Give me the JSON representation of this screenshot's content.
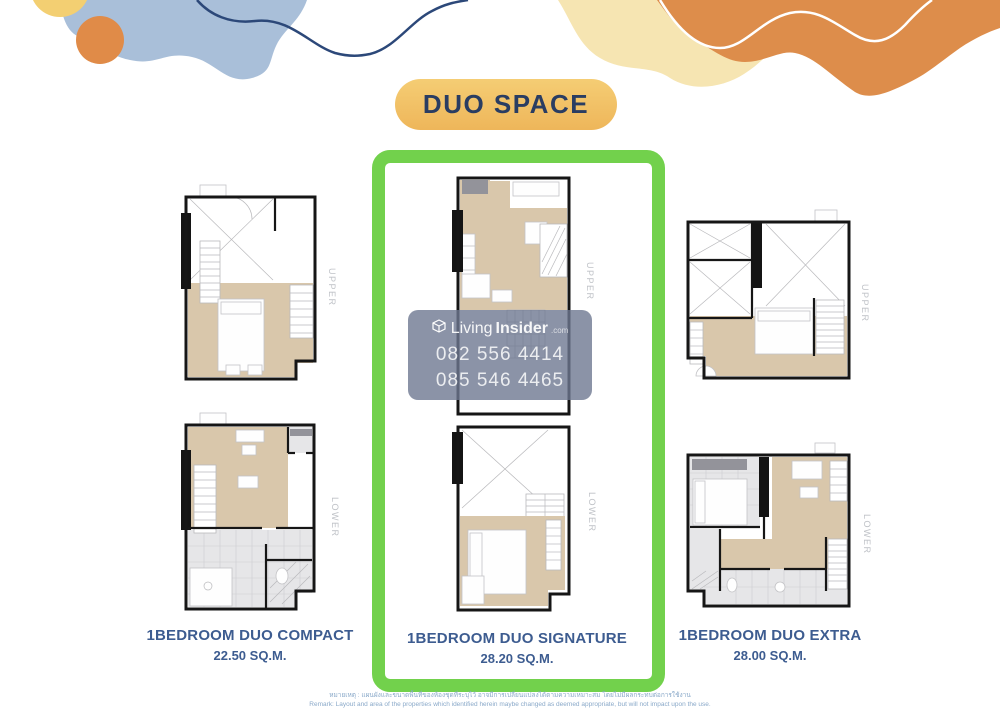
{
  "badge": {
    "label": "DUO SPACE",
    "bg_top": "#f5cd74",
    "bg_bottom": "#eeb65a",
    "text_color": "#2a3d62"
  },
  "accent": {
    "highlight_green": "#72d14c",
    "caption_blue": "#3d5c90"
  },
  "plans": [
    {
      "name": "1BEDROOM DUO COMPACT",
      "area": "22.50 SQ.M.",
      "levels": [
        "UPPER",
        "LOWER"
      ],
      "highlighted": false
    },
    {
      "name": "1BEDROOM DUO SIGNATURE",
      "area": "28.20 SQ.M.",
      "levels": [
        "UPPER",
        "LOWER"
      ],
      "highlighted": true
    },
    {
      "name": "1BEDROOM DUO EXTRA",
      "area": "28.00 SQ.M.",
      "levels": [
        "UPPER",
        "LOWER"
      ],
      "highlighted": false
    }
  ],
  "watermark": {
    "brand_light": "Living",
    "brand_bold": "Insider",
    "brand_suffix": ".com",
    "phone_1": "082 556 4414",
    "phone_2": "085 546 4465",
    "bg": "#6e7891"
  },
  "disclaimer": {
    "line1_th": "หมายเหตุ : แผนผังและขนาดพื้นที่ของห้องชุดที่ระบุไว้ อาจมีการเปลี่ยนแปลงได้ตามความเหมาะสม โดยไม่มีผลกระทบต่อการใช้งาน",
    "line2_en": "Remark: Layout and area of the properties which identified herein maybe changed as deemed appropriate, but will not impact upon the use."
  }
}
